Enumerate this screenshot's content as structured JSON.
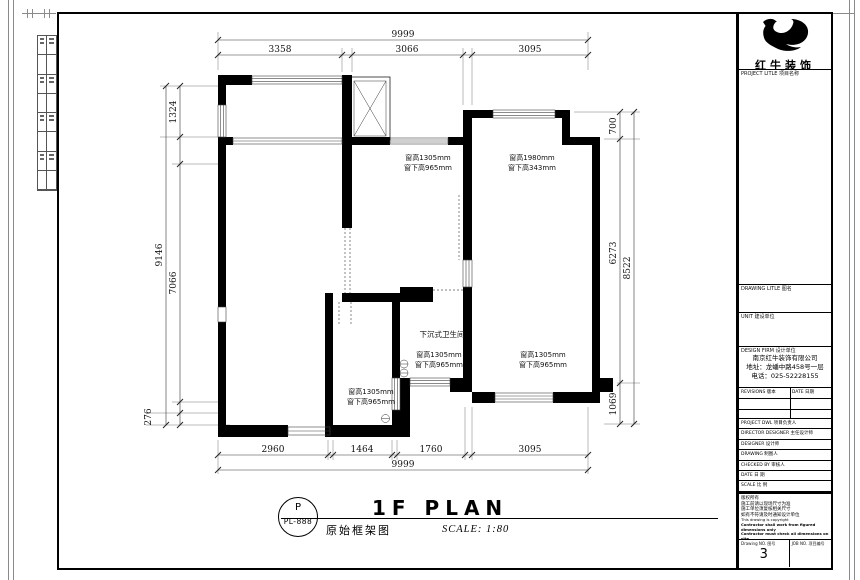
{
  "sheet": {
    "logo": {
      "name": "红牛装饰"
    },
    "title_block": {
      "project_label": "PROJECT LITLE 项目名称",
      "drawing_title_label": "DRAWING LITLE 图名",
      "unit_label": "UNIT 建设单位",
      "design_firm_label": "DESIGN FIRM 设计单位",
      "company_name": "南京红牛装饰有限公司",
      "company_address": "地址：龙蟠中路458号一层",
      "company_phone": "电话：025-52228155",
      "revisions_label": "REVISIONS 版本",
      "revisions_date_label": "DATE 日期",
      "personnel_rows": [
        "PROJECT DWL 项目负责人",
        "DIRECTOR DESIGNER 主任设计师",
        "DESIGNER 设计师",
        "DRAWING 制图人",
        "CHECKED BY 审核人",
        "DATE 日 期",
        "SCALE 比 例"
      ],
      "notes": [
        "版权所有",
        "施工前请以现场尺寸为准",
        "施工单位须复核相关尺寸",
        "如有不符请及时通知设计单位",
        "This drawing is copyright",
        "Contractor shall work from figured dimensions only",
        "Contractor must check all dimensions on site",
        "Omissions must be reported immediately to architects"
      ],
      "drawing_no_label": "Drawing NO. 图号",
      "drawing_no": "3",
      "job_no_label": "JOB NO. 项目编号"
    }
  },
  "plan": {
    "dimensions": {
      "top_overall": "9999",
      "top_1": "3358",
      "top_2": "3066",
      "top_3": "3095",
      "bottom_1": "2960",
      "bottom_2": "1464",
      "bottom_3": "1760",
      "bottom_4": "3095",
      "bottom_overall": "9999",
      "left_overall": "9146",
      "left_1": "1324",
      "left_2": "7066",
      "left_3": "276",
      "right_1": "700",
      "right_2": "6273",
      "right_3": "1069",
      "right_overall": "8522"
    },
    "labels": {
      "room_bath": "下沉式卫生间",
      "win_tl_1": "窗高1305mm",
      "win_tl_2": "窗下高965mm",
      "win_tr_1": "窗高1980mm",
      "win_tr_2": "窗下高343mm",
      "win_mid_1": "窗高1305mm",
      "win_mid_2": "窗下高965mm",
      "win_br_1": "窗高1305mm",
      "win_br_2": "窗下高965mm",
      "win_bath_1": "窗高1305mm",
      "win_bath_2": "窗下高965mm"
    }
  },
  "footer": {
    "detail_ref_top": "P",
    "detail_ref_bottom": "PL-888",
    "plan_title": "1F PLAN",
    "plan_subtitle": "原始框架图",
    "scale_text": "SCALE: 1:80"
  }
}
